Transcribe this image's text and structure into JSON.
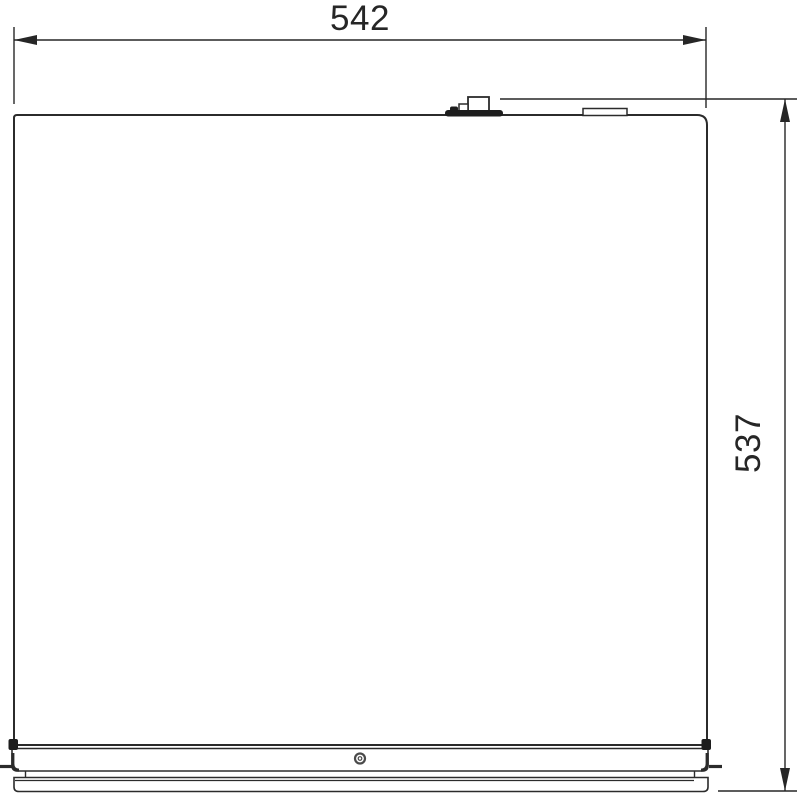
{
  "drawing": {
    "type": "technical-dimension-drawing",
    "view": "top-view-outline",
    "background": "#ffffff",
    "line_color": "#2b2b2b",
    "dim_color": "#262626",
    "fill_white": "#ffffff",
    "dark_fill": "#1d1d1d",
    "width_dim": {
      "label": "542",
      "orientation": "horizontal"
    },
    "height_dim": {
      "label": "537",
      "orientation": "vertical"
    }
  }
}
